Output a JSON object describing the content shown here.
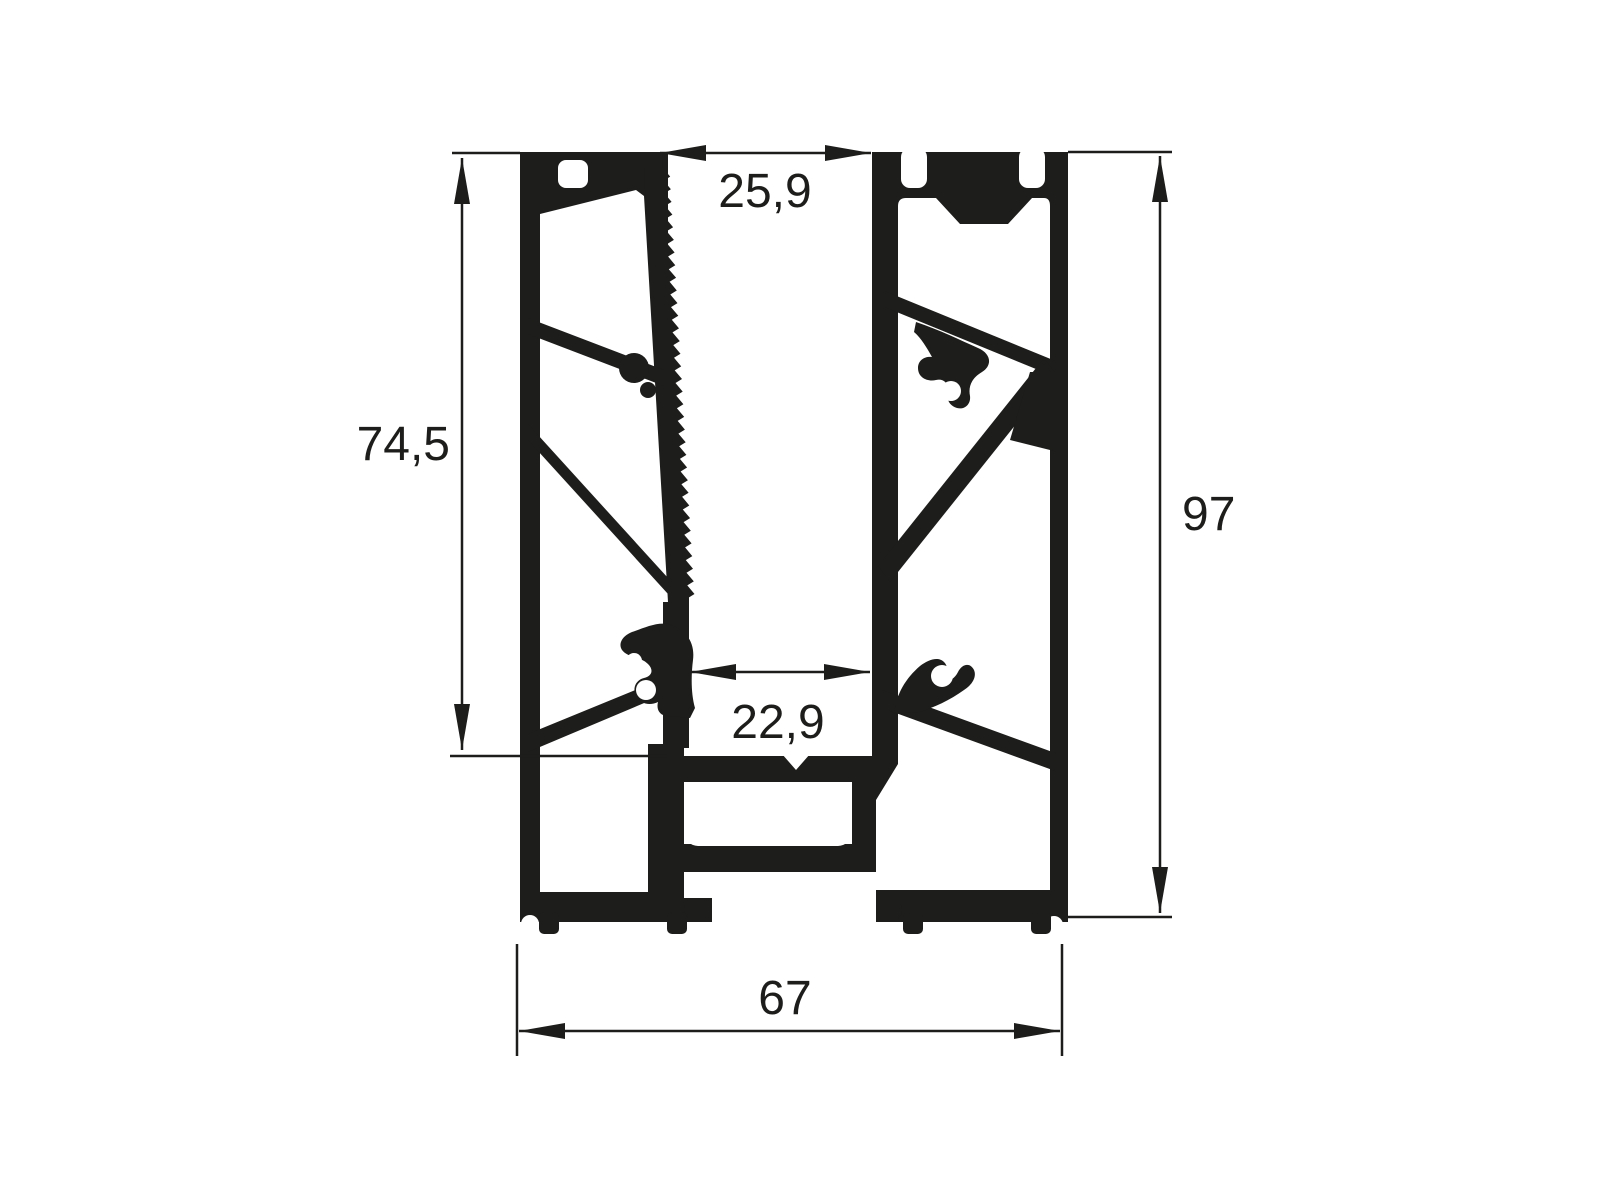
{
  "title": "Aluminium profile cross-section technical drawing",
  "dimensions": {
    "top_width": "25,9",
    "left_height": "74,5",
    "right_height": "97",
    "inner_width": "22,9",
    "bottom_width": "67"
  },
  "colors": {
    "ink": "#1d1d1b",
    "background": "#ffffff"
  }
}
